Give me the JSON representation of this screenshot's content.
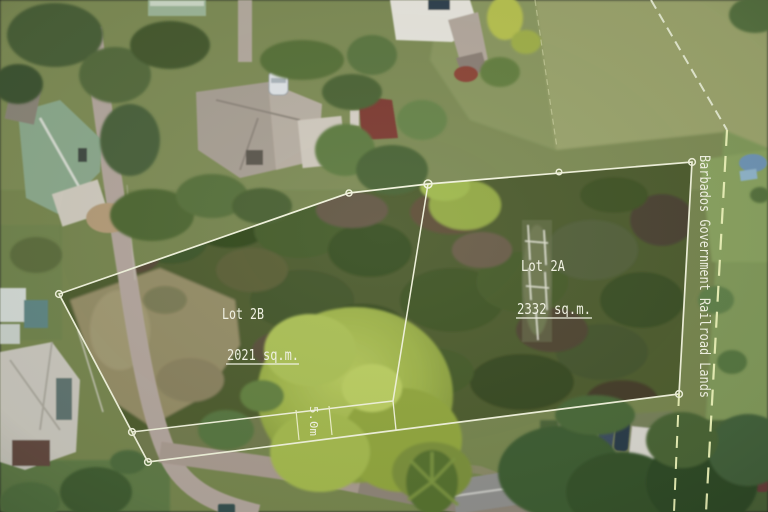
{
  "annotations": {
    "lot_2b": {
      "label": "Lot 2B",
      "area": "2021 sq.m."
    },
    "lot_2a": {
      "label": "Lot 2A",
      "area": "2332 sq.m."
    },
    "railroad": {
      "label": "Barbados Government Railroad Lands"
    },
    "strip": {
      "width_label": "5.0m"
    }
  },
  "colors": {
    "annotation": "#f4f5e6",
    "annotation_line": "#f1f3dc",
    "dashed_line": "#e9f0b6"
  }
}
